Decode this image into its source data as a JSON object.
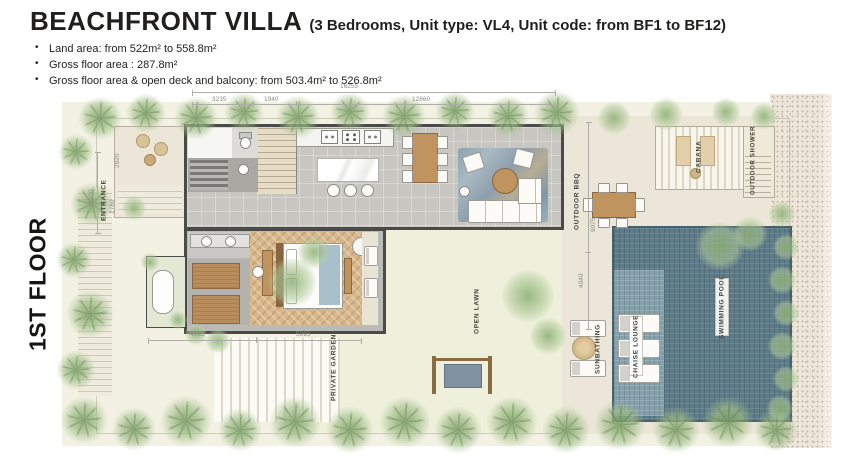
{
  "header": {
    "title": "BEACHFRONT VILLA",
    "subtitle": "(3 Bedrooms, Unit type: VL4, Unit code: from BF1 to BF12)",
    "bullets": [
      "Land area: from 522m² to 558.8m²",
      "Gross floor area : 287.8m²",
      "Gross floor area & open deck and balcony: from 503.4m² to 526.8m²"
    ]
  },
  "floor_label": "1ST FLOOR",
  "rooms": {
    "entrance": "ENTRANCE",
    "outdoor_bbq": "OUTDOOR BBQ",
    "cabana": "CABANA",
    "outdoor_shower": "OUTDOOR SHOWER",
    "swimming_pool": "SWIMMING POOL",
    "chaise_lounge": "CHAISE LOUNGE",
    "sunbathing": "SUNBATHING",
    "open_lawn": "OPEN LAWN",
    "private_garden": "PRIVATE GARDEN"
  },
  "dimensions": {
    "overall_top": "16255",
    "top_1": "3235",
    "top_2": "1940",
    "top_3": "12860",
    "left_side": "8070",
    "entrance_width": "1780",
    "terrace_depth": "2920",
    "right_upper": "9075",
    "right_lower": "4040",
    "bottom_1": "4785",
    "bottom_2": "5095"
  },
  "colors": {
    "pool": "#5e7b88",
    "wood": "#bf945f",
    "wall": "#4a4a48",
    "lawn": "#eef0db",
    "sand": "#ece5d8",
    "text": "#201f1d"
  }
}
